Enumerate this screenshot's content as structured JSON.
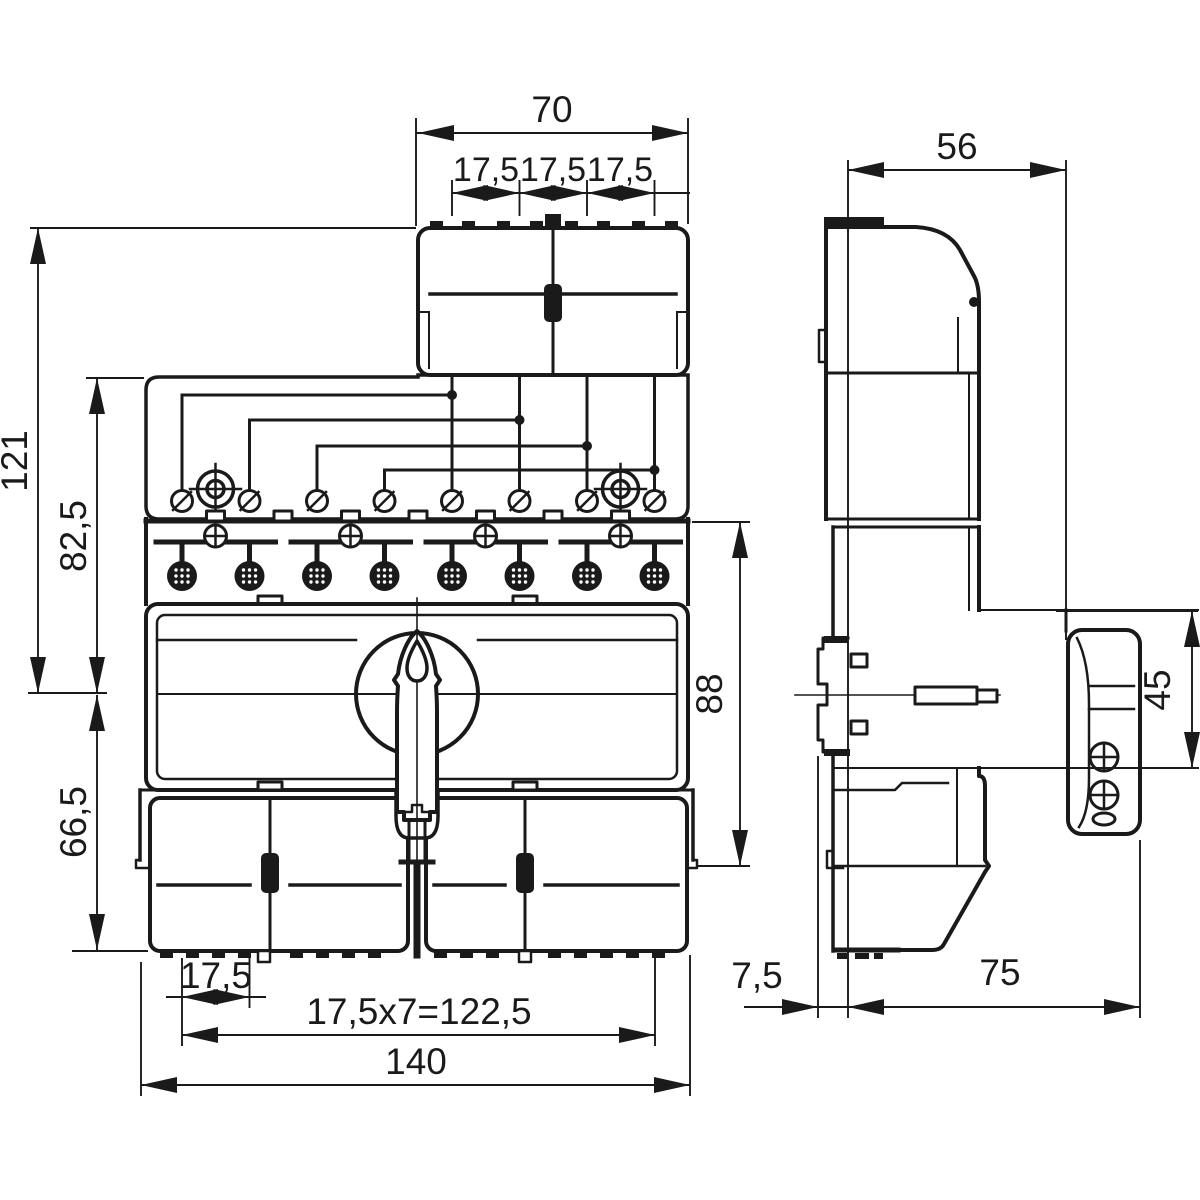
{
  "drawing": {
    "title": "dimension-drawing",
    "units": "mm",
    "line_color": "#1a1a1a",
    "background": "#ffffff",
    "views": {
      "front": "front-view",
      "side": "side-view"
    },
    "dimensions": {
      "front_top_width": "70",
      "front_pitch_1": "17,5",
      "front_pitch_2": "17,5",
      "front_pitch_3": "17,5",
      "front_height_total": "121",
      "front_height_upper": "82,5",
      "front_height_lower": "66,5",
      "front_height_right": "88",
      "front_bottom_pitch": "17,5",
      "front_bottom_span": "17,5x7=122,5",
      "front_bottom_width": "140",
      "side_depth_body": "56",
      "side_handle_height": "45",
      "side_rail_offset": "7,5",
      "side_depth_total": "75"
    }
  }
}
